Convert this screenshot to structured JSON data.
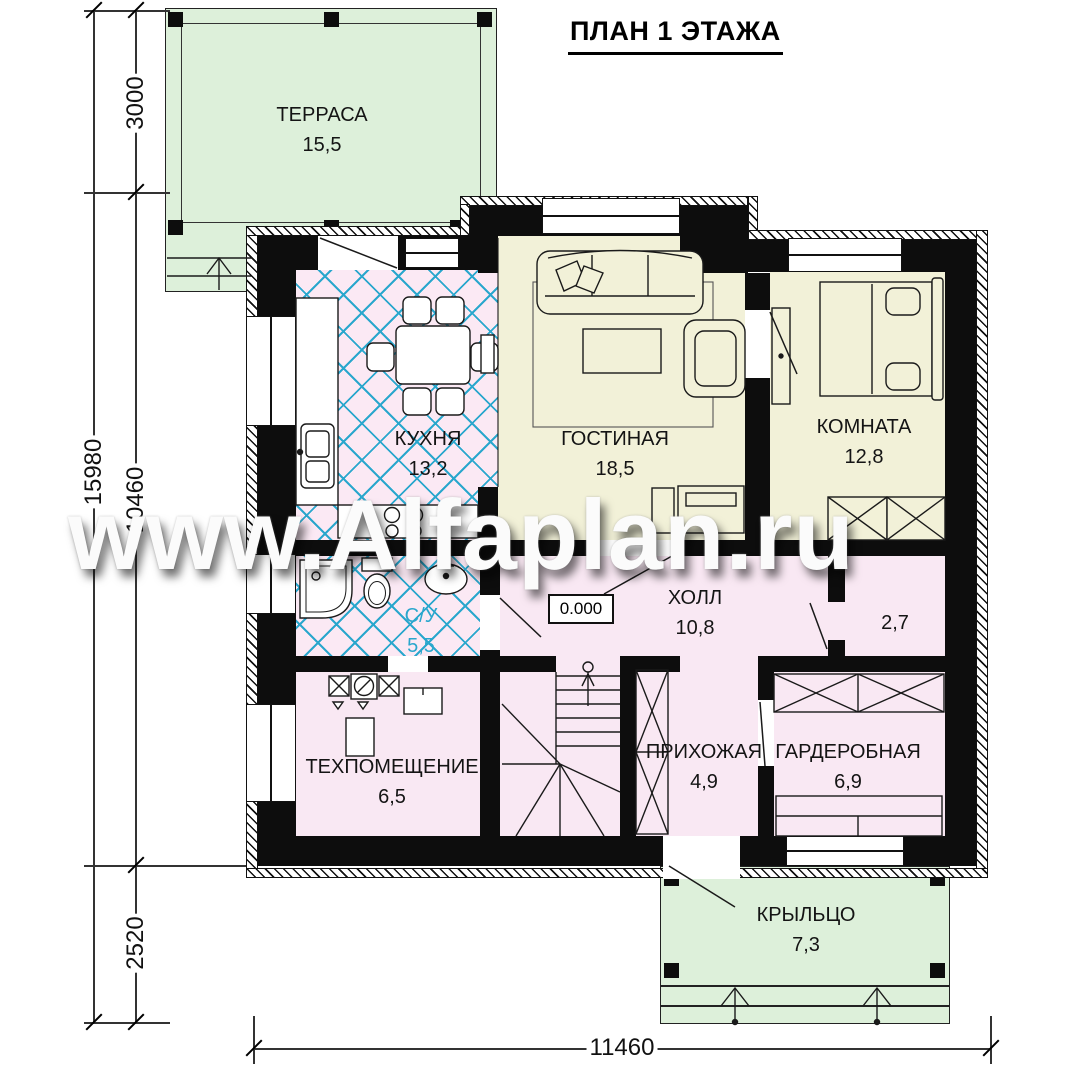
{
  "title": "ПЛАН 1 ЭТАЖА",
  "watermark": "www.Alfaplan.ru",
  "elevation_mark": "0.000",
  "rooms": {
    "terrace": {
      "name": "ТЕРРАСА",
      "area": "15,5"
    },
    "kitchen": {
      "name": "КУХНЯ",
      "area": "13,2"
    },
    "living": {
      "name": "ГОСТИНАЯ",
      "area": "18,5"
    },
    "bedroom": {
      "name": "КОМНАТА",
      "area": "12,8"
    },
    "hall": {
      "name": "ХОЛЛ",
      "area": "10,8"
    },
    "bathroom": {
      "name": "С/У",
      "area": "5,5"
    },
    "tech": {
      "name": "ТЕХПОМЕЩЕНИЕ",
      "area": "6,5"
    },
    "entry": {
      "name": "ПРИХОЖАЯ",
      "area": "4,9"
    },
    "wardrobe": {
      "name": "ГАРДЕРОБНАЯ",
      "area": "6,9"
    },
    "closet": {
      "area": "2,7"
    },
    "porch": {
      "name": "КРЫЛЬЦО",
      "area": "7,3"
    }
  },
  "dimensions": {
    "left_total": "15980",
    "terrace_depth": "3000",
    "house_depth": "10460",
    "porch_depth": "2520",
    "bottom_width": "11460"
  },
  "colors": {
    "terrace_green": "#ddf0da",
    "floor_pink": "#f9e8f3",
    "floor_cream": "#f2f1d8",
    "tile_blue": "#2aa7cd",
    "wall_black": "#0d0d0d"
  }
}
